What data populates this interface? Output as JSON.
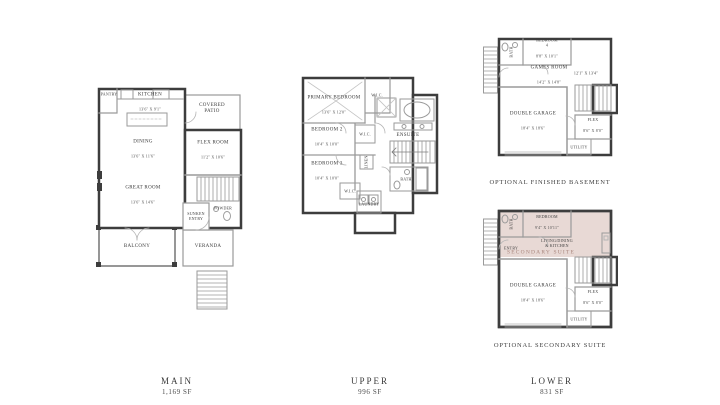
{
  "colors": {
    "wall": "#3d3d3d",
    "suite_shade": "#e8d9d5",
    "suite_label_color": "#a8857c"
  },
  "plans": {
    "main": {
      "rooms": {
        "pantry": "PANTRY",
        "kitchen": "KITCHEN",
        "kitchen_dims": "13'6\" X 9'1\"",
        "covered_patio": "COVERED\nPATIO",
        "flex_room": "FLEX ROOM",
        "flex_room_dims": "11'2\" X 10'6\"",
        "dining": "DINING",
        "dining_dims": "13'6\" X 11'6\"",
        "great_room": "GREAT ROOM",
        "great_room_dims": "13'6\" X 14'6\"",
        "powder": "POWDER",
        "sunken_entry": "SUNKEN\nENTRY",
        "balcony": "BALCONY",
        "veranda": "VERANDA"
      }
    },
    "upper": {
      "rooms": {
        "primary_bedroom": "PRIMARY BEDROOM",
        "primary_bedroom_dims": "13'6\" X 12'0\"",
        "wic": "W.I.C.",
        "ensuite": "ENSUITE",
        "bedroom2": "BEDROOM 2",
        "bedroom2_dims": "10'4\" X 10'0\"",
        "bedroom3": "BEDROOM 3",
        "bedroom3_dims": "10'4\" X 10'0\"",
        "linen": "LINEN",
        "bath": "BATH",
        "laundry": "LAUNDRY"
      }
    },
    "basement": {
      "caption": "OPTIONAL FINISHED BASEMENT",
      "rooms": {
        "bath": "BATH",
        "bedroom4": "BEDROOM\n4",
        "bedroom4_dims": "8'8\" X 10'1\"",
        "games_room": "GAMES ROOM",
        "games_room_dims": "14'2\" X 14'8\"",
        "games_room_dims_right": "12'1\" X 13'4\"",
        "double_garage": "DOUBLE GARAGE",
        "double_garage_dims": "18'4\" X 18'6\"",
        "flex": "FLEX",
        "flex_dims": "8'6\" X 8'0\"",
        "utility": "UTILITY"
      }
    },
    "suite": {
      "caption": "OPTIONAL SECONDARY SUITE",
      "rooms": {
        "bath": "BATH",
        "entry": "ENTRY",
        "bedroom": "BEDROOM",
        "bedroom_dims": "9'4\" X 10'11\"",
        "living": "LIVING/DINING\n& KITCHEN",
        "suite_label": "SECONDARY SUITE",
        "double_garage": "DOUBLE GARAGE",
        "double_garage_dims": "18'4\" X 18'6\"",
        "flex": "FLEX",
        "flex_dims": "8'6\" X 8'0\"",
        "utility": "UTILITY"
      }
    }
  },
  "footer": {
    "floors": [
      {
        "name": "MAIN",
        "area": "1,169 SF"
      },
      {
        "name": "UPPER",
        "area": "996 SF"
      },
      {
        "name": "LOWER",
        "area": "831 SF"
      }
    ]
  }
}
